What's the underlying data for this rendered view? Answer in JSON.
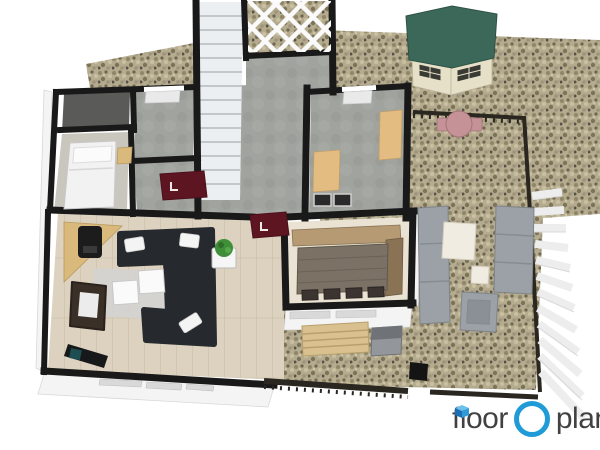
{
  "brand": {
    "logo_word1": "floor",
    "logo_word2": "planner",
    "accent_blue": "#1f9bd8",
    "icon_blue_light": "#6cc0ea",
    "icon_blue_dark": "#1b6fb4",
    "text_color": "#414141"
  },
  "palette": {
    "background": "#ffffff",
    "wall_black": "#191919",
    "gravel_base": "#b5ab8e",
    "concrete_floor": "#a0a39e",
    "wood_floor": "#dcd2bf",
    "dining_floor": "#eae3d3",
    "bedroom_floor": "#c9c6be",
    "closet_floor": "#5a5a58",
    "exterior_wall_white": "#f4f4f4",
    "shed_roof_green": "#3c685a",
    "shed_wall_cream": "#e7e0c9",
    "mat_maroon": "#5e1522",
    "sofa_charcoal": "#26292d",
    "recliner_brown": "#3a3028",
    "hearth_tan": "#d9b97c",
    "counter_tan": "#e3bc82",
    "dining_wood": "#7b7265",
    "corner_bench_wood": "#b59a74",
    "garden_bench_wood": "#d9c18f",
    "patio_gray": "#9ba1a7",
    "outdoor_table_white": "#f1ece2",
    "plant_green": "#3f8f39",
    "fence_dark": "#2a2620",
    "bistro_pink": "#c59397",
    "stair_tread": "#eceff1",
    "rug_gray": "#d3d3d0",
    "desk_black": "#17181a",
    "chair_teal": "#1d4f52",
    "appliance_dark": "#2a2a2a"
  },
  "scene": {
    "type": "3d-floor-plan-render",
    "rooms": [
      {
        "name": "staircase-hall",
        "floor": "concrete"
      },
      {
        "name": "bathroom",
        "floor": "concrete"
      },
      {
        "name": "closet",
        "floor": "dark"
      },
      {
        "name": "bedroom",
        "floor": "light-gray"
      },
      {
        "name": "utility-office",
        "floor": "concrete"
      },
      {
        "name": "living-room",
        "floor": "light-wood"
      },
      {
        "name": "dining-room",
        "floor": "cream"
      },
      {
        "name": "patio",
        "ground": "gravel"
      },
      {
        "name": "garden-yard",
        "ground": "gravel"
      }
    ],
    "furniture_indoor": [
      "single-bed",
      "nightstand",
      "wood-stove",
      "corner-hearth",
      "sectional-sofa",
      "throw-pillows",
      "coffee-tables",
      "area-rug",
      "recliner-armchair",
      "console-desk",
      "desk-chair",
      "potted-plant",
      "plant-stand",
      "dining-table",
      "corner-bench",
      "dining-chairs",
      "kitchen-counters",
      "appliances",
      "door-mats",
      "staircase"
    ],
    "furniture_outdoor": [
      "garden-shed",
      "bistro-table",
      "bistro-chairs",
      "outdoor-sofa-left",
      "outdoor-sofa-right",
      "outdoor-coffee-table",
      "outdoor-side-table",
      "outdoor-armchair",
      "garden-bench",
      "grill-cabinet",
      "picket-fence",
      "garden-fence",
      "pergola-lattice"
    ],
    "door_mat_mark": "L"
  }
}
